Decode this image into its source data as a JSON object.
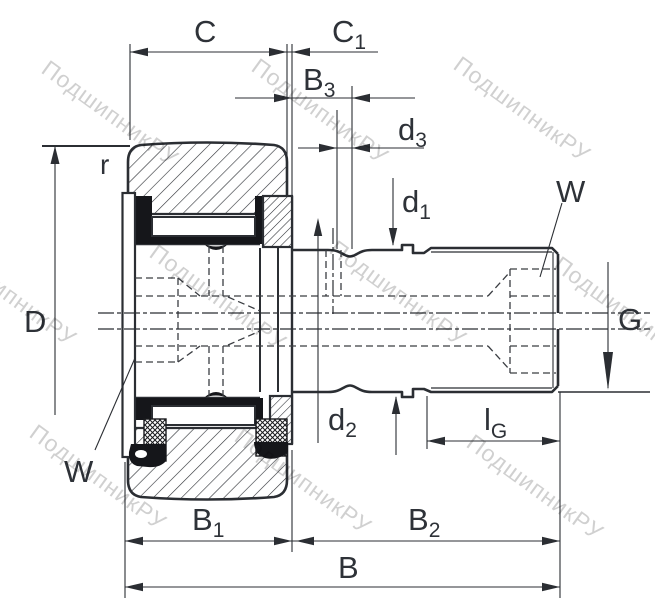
{
  "canvas": {
    "width": 655,
    "height": 611,
    "background": "#ffffff"
  },
  "colors": {
    "line": "#2b2e33",
    "label": "#2e3238",
    "dark_fill": "#15161a",
    "watermark": "#8f8f8f"
  },
  "watermark": {
    "text": "ПодшипникРУ"
  },
  "labels": {
    "C": {
      "main": "C",
      "sub": ""
    },
    "C1": {
      "main": "C",
      "sub": "1"
    },
    "B3": {
      "main": "B",
      "sub": "3"
    },
    "d3": {
      "main": "d",
      "sub": "3"
    },
    "d1": {
      "main": "d",
      "sub": "1"
    },
    "d2": {
      "main": "d",
      "sub": "2"
    },
    "W_top": {
      "main": "W",
      "sub": ""
    },
    "W_bottom": {
      "main": "W",
      "sub": ""
    },
    "G": {
      "main": "G",
      "sub": ""
    },
    "D": {
      "main": "D",
      "sub": ""
    },
    "r": {
      "main": "r",
      "sub": ""
    },
    "lG": {
      "main": "l",
      "sub": "G"
    },
    "B1": {
      "main": "B",
      "sub": "1"
    },
    "B2": {
      "main": "B",
      "sub": "2"
    },
    "B": {
      "main": "B",
      "sub": ""
    }
  }
}
